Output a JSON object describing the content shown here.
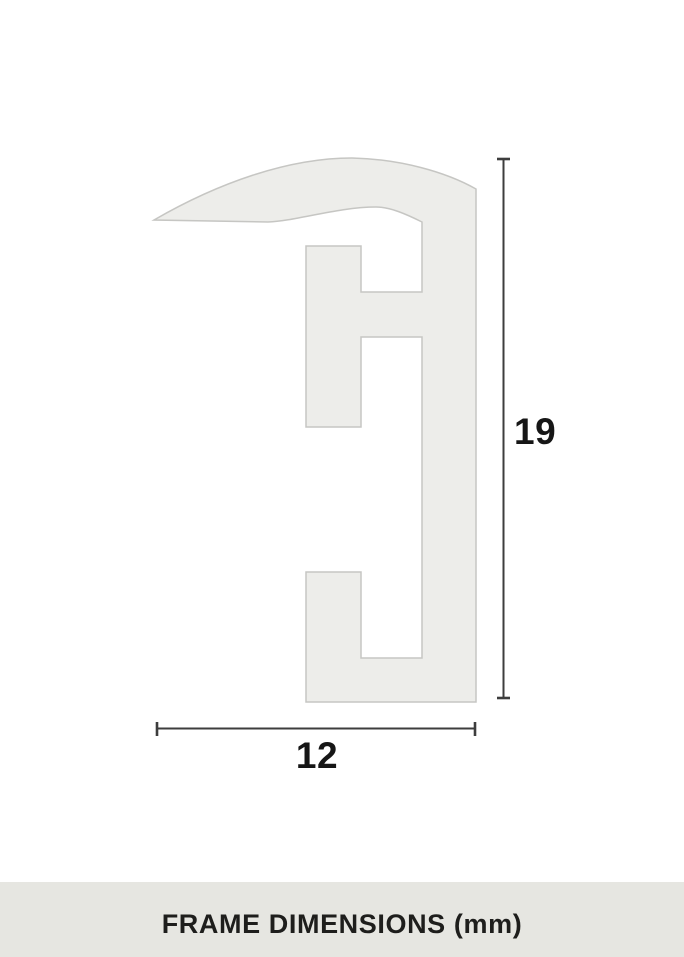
{
  "diagram": {
    "height_dimension": {
      "label": "19"
    },
    "width_dimension": {
      "label": "12"
    }
  },
  "footer": {
    "caption": "FRAME DIMENSIONS (mm)"
  },
  "colors": {
    "background": "#ffffff",
    "profile_fill": "#ededea",
    "profile_stroke": "#c6c6c3",
    "dimension_line": "#3d3d3d",
    "label_text": "#161616",
    "footer_background": "#e6e6e1",
    "footer_text": "#1e1e1c"
  }
}
